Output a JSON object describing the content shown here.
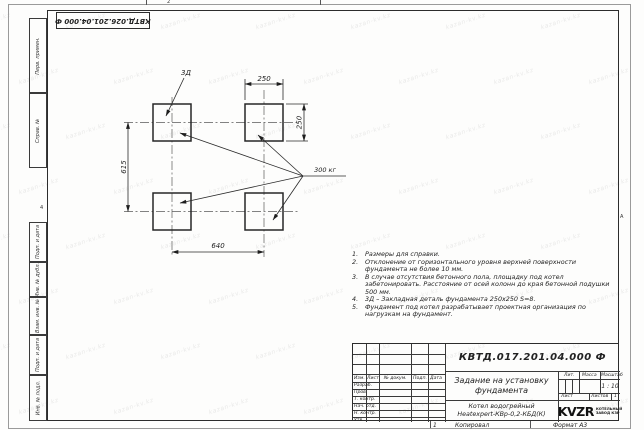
{
  "sheet": {
    "top_stamp": "КВТД.026.201.04.000 Ф",
    "zone_top": "2",
    "zone_right": "А",
    "zone_left": "4",
    "bottom_num": "1",
    "copied_label": "Копировал",
    "format_label": "Формат А3"
  },
  "side_columns": {
    "perv_primen": "Перв. примен.",
    "sprav_no": "Справ. №",
    "podp_data_1": "Подп. и дата",
    "inv_dubl": "Инв. № дубл.",
    "vzam_inv": "Взам. инв. №",
    "podp_data_2": "Подп. и дата",
    "inv_podl": "Инв. № подл."
  },
  "drawing": {
    "detail_label": "3Д",
    "load_label": "300 кг",
    "dim_top": "250",
    "dim_right": "250",
    "dim_left": "615",
    "dim_bottom": "640"
  },
  "notes": [
    {
      "num": "1.",
      "text": "Размеры для справки."
    },
    {
      "num": "2.",
      "text": "Отклонение от горизонтального уровня верхней поверхности фундамента не более 10 мм."
    },
    {
      "num": "3.",
      "text": "В случае отсутствия бетонного пола, площадку под котел забетонировать. Расстояние от осей колонн до края бетонной подушки 500 мм."
    },
    {
      "num": "4.",
      "text": "3Д – Закладная деталь фундамента 250х250 S=8."
    },
    {
      "num": "5.",
      "text": "Фундамент под котел разрабатывает проектная организация по нагрузкам на фундамент."
    }
  ],
  "title_block": {
    "doc_number": "КВТД.017.201.04.000 Ф",
    "title_line1": "Задание на установку",
    "title_line2": "фундамента",
    "product_line1": "Котел водогрейный",
    "product_line2": "Heatexpert-КВр-0,2-КБД(К)",
    "col_izm": "Изм.",
    "col_list": "Лист",
    "col_doc": "№ докум.",
    "col_podp": "Подп.",
    "col_data": "Дата",
    "row_razrab": "Разраб.",
    "row_prov": "Пров.",
    "row_tkontr": "Т. контр.",
    "row_nachotd": "Нач. отд.",
    "row_nkontr": "Н. контр.",
    "row_utv": "Утв.",
    "lit_label": "Лит.",
    "massa_label": "Масса",
    "masshtab_label": "Масштаб",
    "scale_value": "1 : 10",
    "list_label": "Лист",
    "listov_label": "Листов",
    "listov_value": "1",
    "logo_text": "KVZR",
    "logo_sub1": "КОТЕЛЬНЫЙ",
    "logo_sub2": "ЗАВОД КЗР"
  },
  "watermark": {
    "text": "kazan-kv.kz"
  }
}
